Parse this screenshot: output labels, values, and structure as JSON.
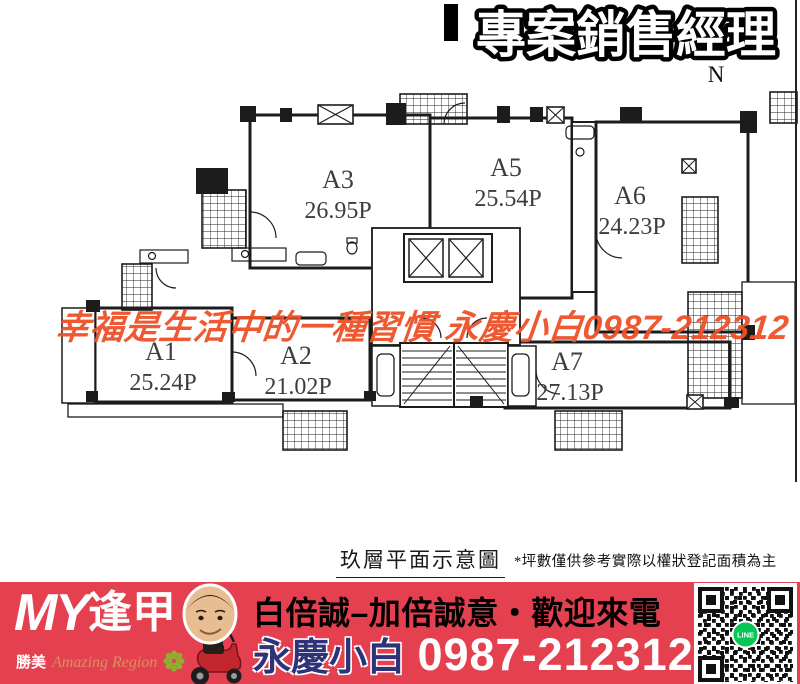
{
  "header": {
    "title": "專案銷售經理",
    "north_label": "N"
  },
  "watermark": {
    "text": "幸福是生活中的一種習慣 永慶小白0987-212312",
    "color": "#ef5128"
  },
  "floorplan": {
    "units": [
      {
        "name": "A3",
        "area": "26.95P"
      },
      {
        "name": "A5",
        "area": "25.54P"
      },
      {
        "name": "A6",
        "area": "24.23P"
      },
      {
        "name": "A1",
        "area": "25.24P"
      },
      {
        "name": "A2",
        "area": "21.02P"
      },
      {
        "name": "A7",
        "area": "27.13P"
      }
    ]
  },
  "caption": {
    "title": "玖層平面示意圖",
    "note": "*坪數僅供參考實際以權狀登記面積為主"
  },
  "footer": {
    "brand": {
      "name_en": "MY",
      "name_cjk": "逢甲",
      "sub_cjk": "勝美",
      "sub_en": "Amazing Region"
    },
    "slogan": "白倍誠–加倍誠意・歡迎來電",
    "agent_name": "永慶小白",
    "phone": "0987-212312",
    "qr_label": "LINE",
    "colors": {
      "banner_red": "#e5404f",
      "agent_navy": "#2e3277",
      "line_green": "#06c755",
      "heading_black": "#000000"
    }
  }
}
